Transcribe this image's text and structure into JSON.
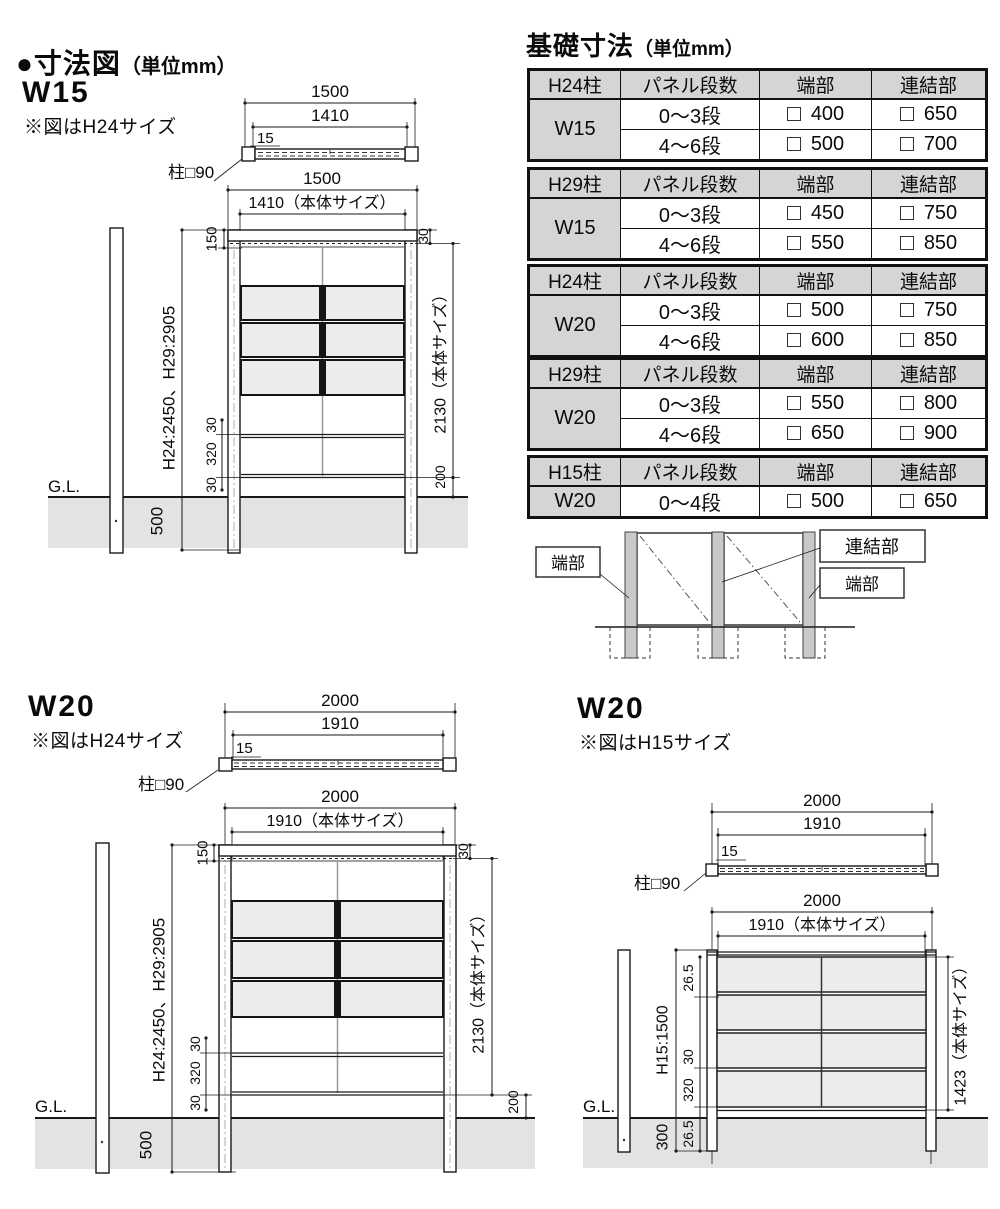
{
  "header": {
    "title": "●寸法図",
    "unit": "（単位mm）"
  },
  "foundation": {
    "title": "基礎寸法",
    "unit": "（単位mm）",
    "tables": [
      {
        "post_col": "H24柱",
        "steps_col": "パネル段数",
        "end_col": "端部",
        "joint_col": "連結部",
        "width": "W15",
        "rows": [
          {
            "steps": "0〜3段",
            "end": "400",
            "joint": "650"
          },
          {
            "steps": "4〜6段",
            "end": "500",
            "joint": "700"
          }
        ]
      },
      {
        "post_col": "H29柱",
        "steps_col": "パネル段数",
        "end_col": "端部",
        "joint_col": "連結部",
        "width": "W15",
        "rows": [
          {
            "steps": "0〜3段",
            "end": "450",
            "joint": "750"
          },
          {
            "steps": "4〜6段",
            "end": "550",
            "joint": "850"
          }
        ]
      },
      {
        "post_col": "H24柱",
        "steps_col": "パネル段数",
        "end_col": "端部",
        "joint_col": "連結部",
        "width": "W20",
        "rows": [
          {
            "steps": "0〜3段",
            "end": "500",
            "joint": "750"
          },
          {
            "steps": "4〜6段",
            "end": "600",
            "joint": "850"
          }
        ]
      },
      {
        "post_col": "H29柱",
        "steps_col": "パネル段数",
        "end_col": "端部",
        "joint_col": "連結部",
        "width": "W20",
        "rows": [
          {
            "steps": "0〜3段",
            "end": "550",
            "joint": "800"
          },
          {
            "steps": "4〜6段",
            "end": "650",
            "joint": "900"
          }
        ]
      },
      {
        "post_col": "H15柱",
        "steps_col": "パネル段数",
        "end_col": "端部",
        "joint_col": "連結部",
        "width": "W20",
        "rows": [
          {
            "steps": "0〜4段",
            "end": "500",
            "joint": "650"
          }
        ]
      }
    ]
  },
  "connection": {
    "end_left": "端部",
    "joint": "連結部",
    "end_right": "端部"
  },
  "w15": {
    "name": "W15",
    "note": "※図はH24サイズ",
    "plan": {
      "overall": "1500",
      "body": "1410",
      "inset": "15",
      "post_label": "柱□90"
    },
    "elev": {
      "overall": "1500",
      "body": "1410（本体サイズ）",
      "top_margin": "150",
      "top_offset": "30",
      "post_height": "H24:2450、H29:2905",
      "body_height": "2130（本体サイズ）",
      "rail_top": "30",
      "rail_mid": "320",
      "rail_bot": "30",
      "bottom_gap": "200",
      "gl": "G.L.",
      "embed": "500"
    }
  },
  "w20h24": {
    "name": "W20",
    "note": "※図はH24サイズ",
    "plan": {
      "overall": "2000",
      "body": "1910",
      "inset": "15",
      "post_label": "柱□90"
    },
    "elev": {
      "overall": "2000",
      "body": "1910（本体サイズ）",
      "top_margin": "150",
      "top_offset": "30",
      "post_height": "H24:2450、H29:2905",
      "body_height": "2130（本体サイズ）",
      "rail_top": "30",
      "rail_mid": "320",
      "rail_bot": "30",
      "bottom_gap": "200",
      "gl": "G.L.",
      "embed": "500"
    }
  },
  "w20h15": {
    "name": "W20",
    "note": "※図はH15サイズ",
    "plan": {
      "overall": "2000",
      "body": "1910",
      "inset": "15",
      "post_label": "柱□90"
    },
    "elev": {
      "overall": "2000",
      "body": "1910（本体サイズ）",
      "top_offset": "26.5",
      "post_height": "H15:1500",
      "body_height": "1423（本体サイズ）",
      "rail_top": "30",
      "rail_mid": "320",
      "rail_bot": "26.5",
      "gl": "G.L.",
      "embed": "300"
    }
  },
  "colors": {
    "table_header_bg": "#d5d5d5",
    "ground": "#e3e3e3",
    "panel_fill": "#ececec",
    "post_fill": "#c9c9c9",
    "line": "#1a1a1a"
  }
}
